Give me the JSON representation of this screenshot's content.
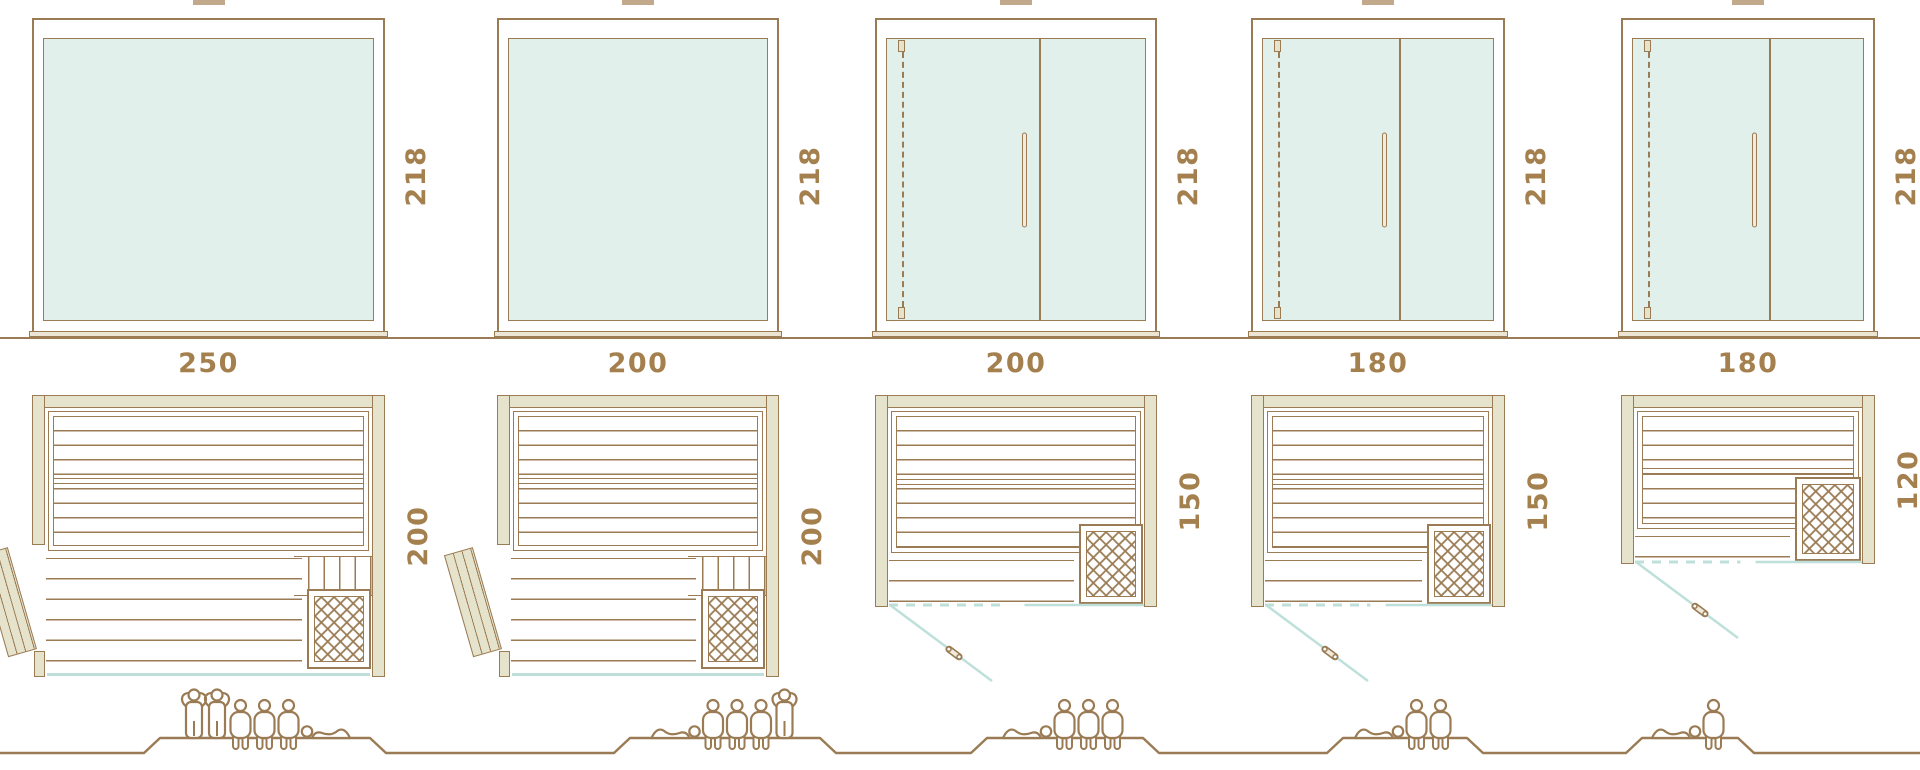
{
  "diagram_kind": "sauna-cabin-size-comparison",
  "colors": {
    "line_brown": "#9a7b54",
    "label_brown": "#a5804f",
    "wall_khaki": "#e6e3cd",
    "glass_mint": "#e2f0eb",
    "teal": "#bfe0da",
    "handle_fill": "#f1ebdc",
    "sill_fill": "#ece5d4",
    "crop_tan": "#c2a98c"
  },
  "units": [
    {
      "front_width_label": "250",
      "front_height_label": "218",
      "plan_depth_label": "200",
      "door": "side",
      "capacity": [
        "standing",
        "standing",
        "sitting",
        "sitting",
        "sitting",
        "lying-head-left"
      ]
    },
    {
      "front_width_label": "200",
      "front_height_label": "218",
      "plan_depth_label": "200",
      "door": "side",
      "capacity": [
        "lying-head-right",
        "sitting",
        "sitting",
        "sitting",
        "standing"
      ]
    },
    {
      "front_width_label": "200",
      "front_height_label": "218",
      "plan_depth_label": "150",
      "door": "front-glass",
      "capacity": [
        "lying-head-right",
        "sitting",
        "sitting",
        "sitting"
      ]
    },
    {
      "front_width_label": "180",
      "front_height_label": "218",
      "plan_depth_label": "150",
      "door": "front-glass",
      "capacity": [
        "lying-head-right",
        "sitting",
        "sitting"
      ]
    },
    {
      "front_width_label": "180",
      "front_height_label": "218",
      "plan_depth_label": "120",
      "door": "front-glass",
      "capacity": [
        "lying-head-right",
        "sitting"
      ]
    }
  ]
}
